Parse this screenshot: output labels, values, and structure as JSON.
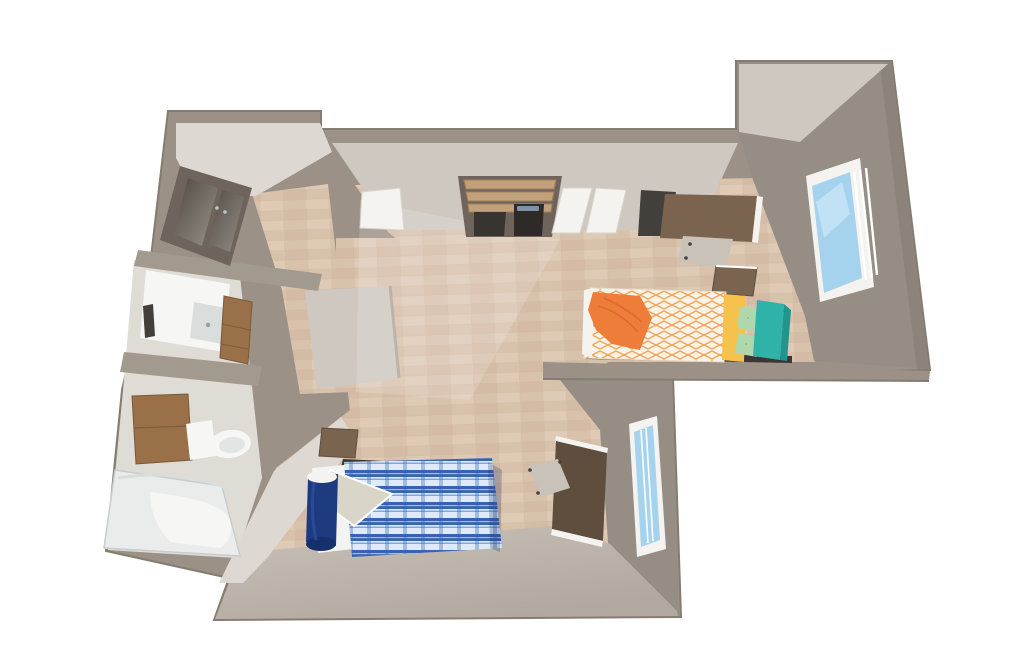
{
  "scene": {
    "kind": "3d-floorplan-render",
    "description": "Perspective 3D floor plan of a studio residence unit with entry hall, bathroom, closets and a shared bedroom area with two twin beds, two desks and two windows",
    "background": "#ffffff"
  },
  "palette": {
    "wallTop": "#9b9186",
    "wallEdge": "#857c71",
    "wallFaceLight": "#cfc8c0",
    "wallFaceLighter": "#ddd8d1",
    "wallFaceGray": "#968e85",
    "wallBandDark": "#a39a8f",
    "bottomWallLight": "#c9c1b8",
    "bottomWallDark": "#b1a89f",
    "floorWood": "#d8c2ac",
    "floorWoodDark": "#d0b69e",
    "floorWoodLight": "#e2ceba",
    "floorLine": "#c8ae95",
    "bathFloor": "#dfdbd5",
    "white": "#f4f3f0",
    "glassBlue": "#a5d3ee",
    "glassStreak": "#cde7f6",
    "doorFrame": "#6e645c",
    "doorPanelDark": "#4e4840",
    "doorPanelLight": "#9a938b",
    "handleDot": "#b9c7cc",
    "cabinetBrown": "#9a7048",
    "cabinetBrownDark": "#7c5836",
    "deskBrown": "#7a6450",
    "deskBrownDark": "#5f4e3e",
    "shelfTan": "#c0a179",
    "shelfTanDark": "#a3805a",
    "dresserDark": "#38342f",
    "applianceDark": "#2d2a27",
    "controlPanel": "#7f93a8",
    "chairDark": "#43403c",
    "chairLight": "#c8c2b9",
    "bedWhite": "#f9f2e8",
    "bedOrangePattern": "#efa452",
    "throwOrange": "#ee7d3a",
    "throwOrangeDark": "#d96526",
    "pillowYellow": "#f6c14c",
    "pillowMint": "#aed8ab",
    "pillowMintDark": "#8fc18c",
    "headboardTeal": "#2fb3a9",
    "headboardTealDark": "#1f958d",
    "bedBaseDark": "#3a3633",
    "plaidBase": "#dcebf7",
    "plaidBlue": "#3763af",
    "sheetWhite": "#f3f4f2",
    "sheetFold": "#d9d5c8",
    "rollNavy": "#1f3b80",
    "rollNavyDark": "#16306b",
    "rollHighlight": "#2c4f9e",
    "fixtureWhite": "#f6f6f4",
    "fixtureShadow": "#d9dedd",
    "tubFill": "#e9eceb",
    "tubRim": "#c7cdcc",
    "sheen": "#ffffff"
  },
  "rooms": {
    "entry": {
      "name": "entry-hall",
      "objects": [
        "entry-door",
        "wood-floor"
      ]
    },
    "bathroom": {
      "name": "bathroom",
      "objects": [
        "vanity-sink",
        "towel",
        "side-cabinet",
        "medicine-cabinet",
        "toilet",
        "bathtub",
        "shower-rod"
      ]
    },
    "main_room": {
      "name": "studio-bedroom",
      "objects": [
        "closet-shelves",
        "dresser",
        "small-appliance",
        "sliding-mirror-doors",
        "second-closet",
        "desk-1",
        "desk-chair-1",
        "nightstand-1",
        "bed-1-orange",
        "orange-throw",
        "yellow-pillow",
        "mint-cushions",
        "teal-headboard",
        "window-1",
        "nightstand-2",
        "wall-shelf",
        "bed-2-blue-plaid",
        "navy-bolster",
        "folded-sheet",
        "desk-2",
        "desk-chair-2",
        "window-2"
      ]
    }
  }
}
